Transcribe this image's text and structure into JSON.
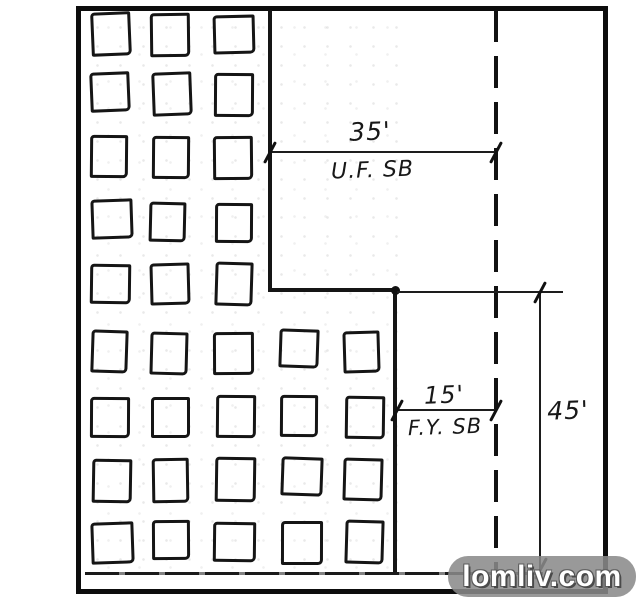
{
  "colors": {
    "ink": "#151515",
    "paper": "#ffffff",
    "watermark_bg": "#8a8a8a",
    "watermark_text": "#ffffff"
  },
  "sketch": {
    "type": "hand-drawn site plan setback sketch",
    "dimensions": {
      "top": {
        "value": "35'",
        "sublabel": "U.F. SB"
      },
      "middle": {
        "value": "15'",
        "sublabel": "F.Y. SB"
      },
      "right": {
        "value": "45'"
      }
    },
    "building_grid": {
      "rows": 9,
      "upper_cols": 3,
      "lower_cols": 5,
      "lower_first_row": 6
    }
  },
  "watermark": {
    "text": "lomliv.com"
  }
}
